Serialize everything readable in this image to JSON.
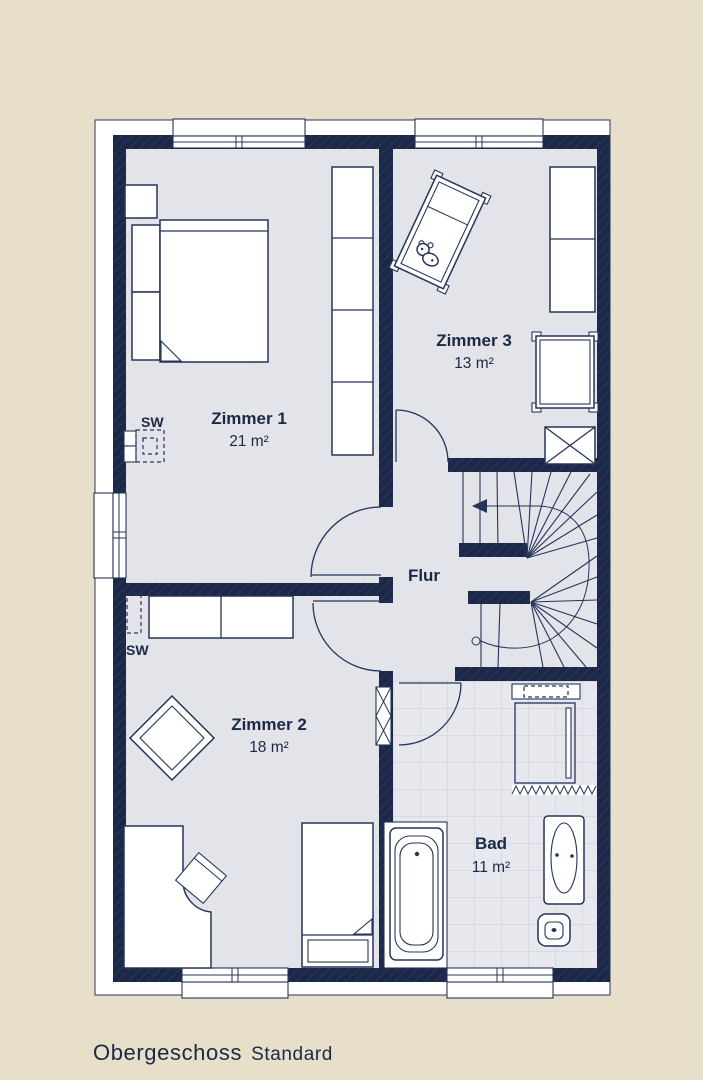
{
  "plan": {
    "rooms": [
      {
        "name": "Zimmer 1",
        "area": "21 m²"
      },
      {
        "name": "Zimmer 2",
        "area": "18 m²"
      },
      {
        "name": "Zimmer 3",
        "area": "13 m²"
      },
      {
        "name": "Flur",
        "area": ""
      },
      {
        "name": "Bad",
        "area": "11 m²"
      }
    ],
    "markers": {
      "sw_zimmer1": "SW",
      "sw_zimmer2": "SW"
    },
    "colors": {
      "bg": "#e8dfca",
      "wall": "#1c2847",
      "wallhatch": "#2e3c63",
      "floor": "#e2e4ea",
      "tile": "#e6e8ee",
      "tileline": "#c7ccd9",
      "line": "#26345a",
      "text": "#1b2846",
      "white": "#ffffff"
    }
  },
  "caption": {
    "title": "Obergeschoss",
    "subtitle": "Standard"
  }
}
